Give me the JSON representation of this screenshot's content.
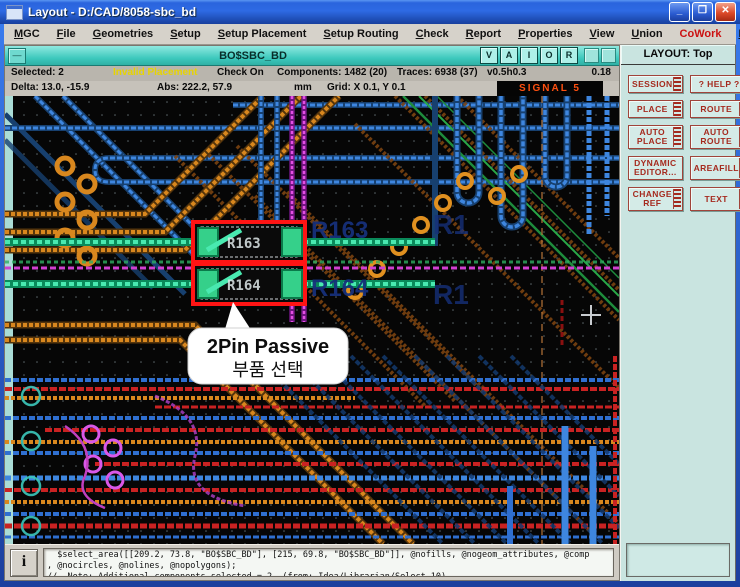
{
  "window": {
    "title": "Layout - D:/CAD/8058-sbc_bd",
    "controls": {
      "minimize": "_",
      "maximize": "❐",
      "close": "✕"
    }
  },
  "menu": {
    "items": [
      "MGC",
      "File",
      "Geometries",
      "Setup",
      "Setup Placement",
      "Setup Routing",
      "Check",
      "Report",
      "Properties",
      "View",
      "Union",
      "CoWork",
      "Help",
      "Support"
    ],
    "cowork_color": "#cc1111"
  },
  "subwindow": {
    "title": "BO$SBC_BD",
    "view_buttons": [
      "V",
      "A",
      "I",
      "O",
      "R"
    ]
  },
  "status": {
    "selected": "Selected: 2",
    "warning": "Invalid Placement",
    "check": "Check On",
    "components": "Components: 1482 (20)",
    "traces": "Traces: 6938 (37)",
    "via_size": "v0.5h0.3",
    "value_right": "0.18",
    "delta": "Delta:   13.0, -15.9",
    "abs": "Abs:   222.2, 57.9",
    "units": "mm",
    "grid": "Grid: X 0.1, Y 0.1",
    "active_layer": "SIGNAL 5",
    "warning_color": "#e8d400",
    "layer_color": "#ff5010"
  },
  "panel": {
    "header": "LAYOUT: Top",
    "buttons": [
      "SESSION",
      "? HELP ?",
      "PLACE",
      "ROUTE",
      "AUTO\nPLACE",
      "AUTO\nROUTE",
      "DYNAMIC\nEDITOR...",
      "AREAFILL",
      "CHANGE\nREF",
      "TEXT"
    ],
    "accent_color": "#a52a1e"
  },
  "canvas": {
    "callout": {
      "line1": "2Pin Passive",
      "line2": "부품 선택"
    },
    "component_refs": {
      "r163": "R163",
      "r164": "R164"
    },
    "neighbor_refs": {
      "right_top": "R1",
      "right_bottom": "R1"
    },
    "colors": {
      "background": "#060606",
      "trace_blue": "#3e86df",
      "trace_orange": "#d8871e",
      "trace_red": "#c92222",
      "trace_magenta": "#e34fe3",
      "pad_green": "#49e9b0",
      "highlight_red": "#ff1414"
    }
  },
  "console": {
    "info_icon": "i",
    "lines": [
      "  $select_area([[209.2, 73.8, \"BO$SBC_BD\"], [215, 69.8, \"BO$SBC_BD\"]], @nofills, @nogeom_attributes, @comp",
      ", @nocircles, @nolines, @nopolygons);",
      "//  Note: Additional components selected = 2. (from: Idea/Librarian/Select 10)"
    ]
  }
}
